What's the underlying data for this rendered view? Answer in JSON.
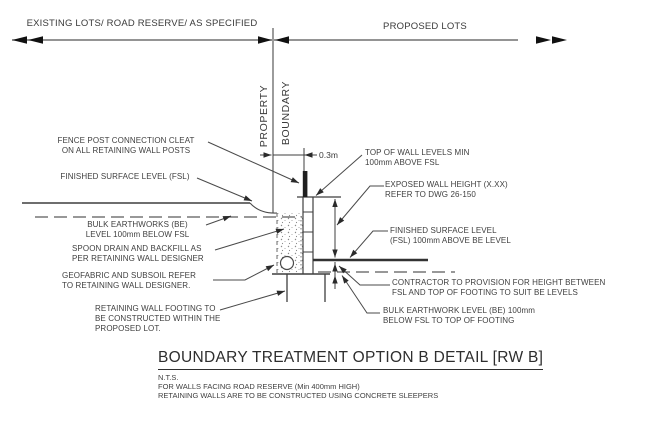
{
  "regions": {
    "existing": "EXISTING LOTS/ ROAD RESERVE/ AS SPECIFIED",
    "proposed": "PROPOSED LOTS"
  },
  "boundary_labels": {
    "property": "PROPERTY",
    "boundary": "BOUNDARY"
  },
  "dimension": {
    "offset": "0.3m"
  },
  "annotations": {
    "fence_post": {
      "l1": "FENCE POST CONNECTION CLEAT",
      "l2": "ON ALL RETAINING WALL POSTS"
    },
    "fsl_left": {
      "l1": "FINISHED SURFACE LEVEL (FSL)"
    },
    "bulk_left": {
      "l1": "BULK EARTHWORKS (BE)",
      "l2": "LEVEL 100mm BELOW FSL"
    },
    "spoon": {
      "l1": "SPOON DRAIN AND BACKFILL AS",
      "l2": "PER RETAINING WALL DESIGNER"
    },
    "geofabric": {
      "l1": "GEOFABRIC AND SUBSOIL REFER",
      "l2": "TO RETAINING WALL DESIGNER."
    },
    "footing": {
      "l1": "RETAINING WALL FOOTING TO",
      "l2": "BE CONSTRUCTED WITHIN THE",
      "l3": "PROPOSED LOT."
    },
    "top_of_wall": {
      "l1": "TOP OF WALL LEVELS MIN",
      "l2": "100mm ABOVE FSL"
    },
    "exposed": {
      "l1": "EXPOSED WALL HEIGHT (X.XX)",
      "l2": "REFER TO DWG 26-150"
    },
    "fsl_right": {
      "l1": "FINISHED SURFACE LEVEL",
      "l2": "(FSL) 100mm ABOVE BE LEVEL"
    },
    "contractor": {
      "l1": "CONTRACTOR TO PROVISION FOR HEIGHT BETWEEN",
      "l2": "FSL AND TOP OF FOOTING TO SUIT BE LEVELS"
    },
    "bulk_right": {
      "l1": "BULK EARTHWORK LEVEL (BE) 100mm",
      "l2": "BELOW  FSL TO TOP OF FOOTING"
    }
  },
  "title_block": {
    "title": "BOUNDARY TREATMENT OPTION B DETAIL [RW B]",
    "note1": "N.T.S.",
    "note2": "FOR WALLS FACING ROAD RESERVE (Min 400mm HIGH)",
    "note3": "RETAINING WALLS ARE TO BE CONSTRUCTED USING CONCRETE SLEEPERS"
  },
  "colors": {
    "line": "#4a4a4a",
    "arrow": "#1a1a1a",
    "text": "#3f3f3f",
    "background": "#ffffff"
  }
}
